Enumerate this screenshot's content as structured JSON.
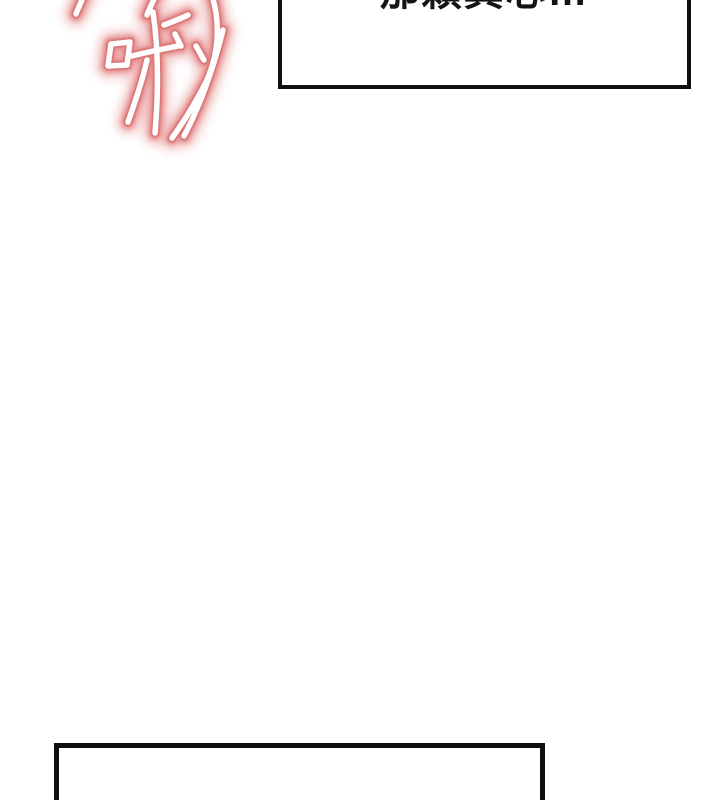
{
  "page": {
    "background_color": "#ffffff"
  },
  "sfx": {
    "text": "啾",
    "core_color": "#ffffff",
    "glow_edge_color": "#d97474",
    "glow_mid_color": "#e69191",
    "glow_outer_color": "#f2bdbd"
  },
  "bubbles": {
    "top": {
      "text": "那顆真心…",
      "text_color": "#141414",
      "border_color": "#101010",
      "fill_color": "#ffffff"
    },
    "bottom": {
      "text": "",
      "border_color": "#101010",
      "fill_color": "#ffffff"
    }
  }
}
